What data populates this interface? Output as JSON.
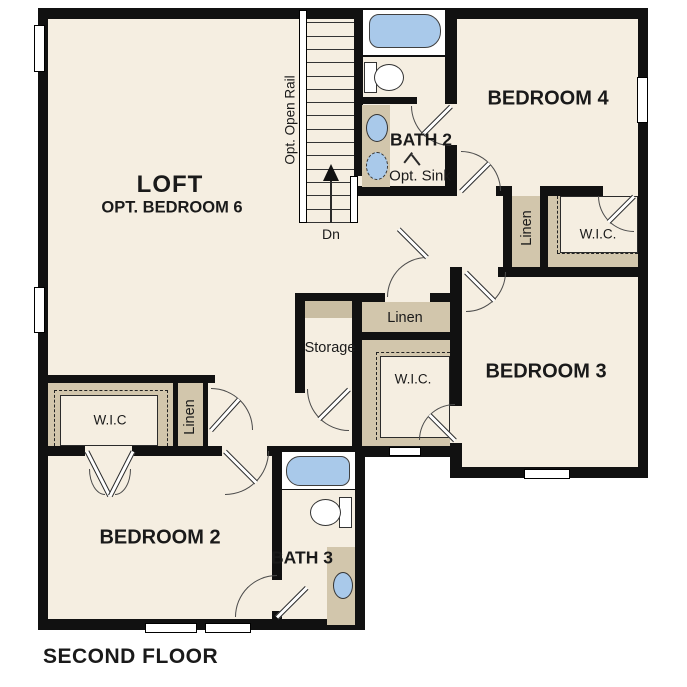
{
  "title": "SECOND FLOOR",
  "rooms": {
    "loft": {
      "name": "LOFT",
      "subtitle": "OPT. BEDROOM 6"
    },
    "bedroom4": {
      "name": "BEDROOM 4"
    },
    "bedroom3": {
      "name": "BEDROOM 3"
    },
    "bedroom2": {
      "name": "BEDROOM 2"
    },
    "bath2": {
      "name": "BATH 2",
      "note": "Opt. Sink"
    },
    "bath3": {
      "name": "BATH 3"
    },
    "storage": {
      "name": "Storage"
    },
    "linen_hall": {
      "name": "Linen"
    },
    "linen_bedroom2": {
      "name": "Linen"
    },
    "linen_bedroom4": {
      "name": "Linen"
    },
    "wic_bedroom2": {
      "name": "W.I.C"
    },
    "wic_bedroom3": {
      "name": "W.I.C."
    },
    "wic_bedroom4": {
      "name": "W.I.C."
    }
  },
  "stairs": {
    "down_label": "Dn",
    "rail_label": "Opt. Open Rail"
  },
  "colors": {
    "background": "#ffffff",
    "floor": "#f5eee1",
    "wall": "#111111",
    "closet_tan": "#d2c6ac",
    "fixture_blue": "#a9c9ea"
  }
}
